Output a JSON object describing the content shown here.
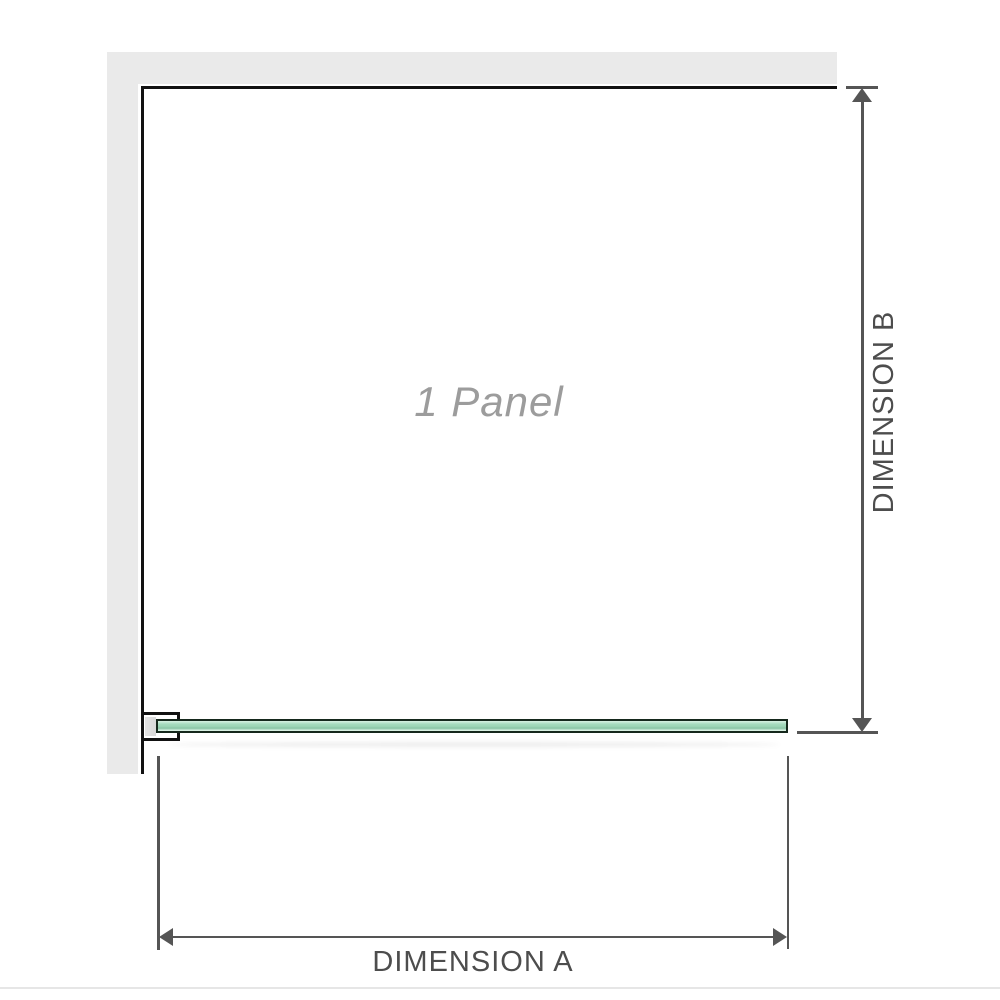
{
  "diagram": {
    "panel_label": "1 Panel",
    "dimension_a": {
      "label": "DIMENSION A"
    },
    "dimension_b": {
      "label": "DIMENSION B"
    }
  },
  "colors": {
    "wall_fill": "#eaeaea",
    "wall_edge": "#111111",
    "dimension_line": "#555555",
    "label_text": "#4d4d4d",
    "panel_label_text": "#9c9c9c",
    "glass_border": "#15281c",
    "glass_light": "#d9f0e3",
    "glass_mid": "#a5dabd",
    "glass_deep": "#89c4a4",
    "bracket_pad": "#d8d8d8",
    "bottom_rule": "#e6e6e6"
  }
}
